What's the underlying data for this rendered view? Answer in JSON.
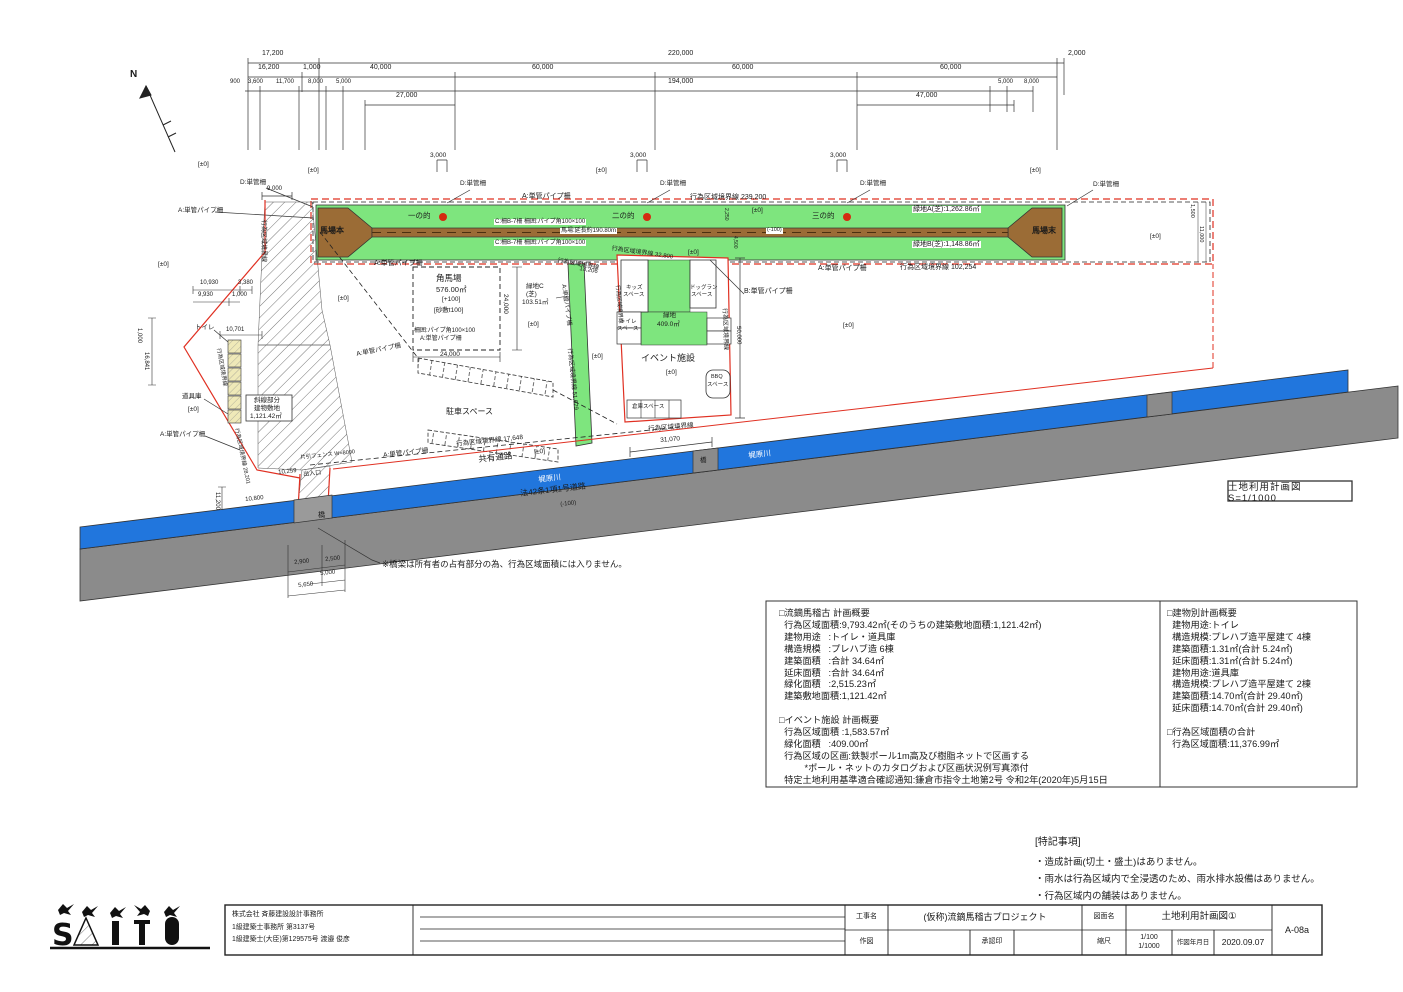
{
  "stamp": "土地利用計画図  S=1/1000",
  "notes": {
    "title": "[特記事項]",
    "items": [
      "・造成計画(切土・盛土)はありません。",
      "・雨水は行為区域内で全浸透のため、雨水排水設備はありません。",
      "・行為区域内の舗装はありません。"
    ]
  },
  "summary": {
    "left": [
      "□流鏑馬稽古 計画概要",
      "  行為区域面積:9,793.42㎡(そのうちの建築敷地面積:1,121.42㎡)",
      "  建物用途   :トイレ・道具庫",
      "  構造規模   :プレハブ造 6棟",
      "  建築面積   :合計 34.64㎡",
      "  延床面積   :合計 34.64㎡",
      "  緑化面積   :2,515.23㎡",
      "  建築敷地面積:1,121.42㎡",
      "",
      "□イベント施設 計画概要",
      "  行為区域面積 :1,583.57㎡",
      "  緑化面積   :409.00㎡",
      "  行為区域の区画:鉄製ポール1m高及び樹脂ネットで区画する",
      "          *ポール・ネットのカタログおよび区画状況例写真添付",
      "  特定土地利用基準適合確認通知:鎌倉市指令土地第2号 令和2年(2020年)5月15日"
    ],
    "right": [
      "□建物別計画概要",
      "  建物用途:トイレ",
      "  構造規模:プレハブ造平屋建て 4棟",
      "  建築面積:1.31㎡(合計 5.24㎡)",
      "  延床面積:1.31㎡(合計 5.24㎡)",
      "  建物用途:道具庫",
      "  構造規模:プレハブ造平屋建て 2棟",
      "  建築面積:14.70㎡(合計 29.40㎡)",
      "  延床面積:14.70㎡(合計 29.40㎡)",
      "",
      "□行為区域面積の合計",
      "  行為区域面積:11,376.99㎡"
    ]
  },
  "titleblock": {
    "company_lines": [
      "株式会社 斉藤建設設計事務所",
      "1級建築士事務所 第3137号",
      "1級建築士(大臣)第129575号 渡邉 俊彦"
    ],
    "labels": {
      "project": "工事名",
      "drawn": "作図",
      "approval": "承認印",
      "drawing_name": "図面名",
      "scale": "縮尺",
      "date": "作図年月日"
    },
    "values": {
      "project": "(仮称)流鏑馬稽古プロジェクト",
      "drawing_name": "土地利用計画図①",
      "scale1": "1/100",
      "scale2": "1/1000",
      "date": "2020.09.07",
      "sheet": "A-08a"
    }
  },
  "colors": {
    "turf_green": "#7ee57e",
    "track_brown": "#9b6c36",
    "river_blue": "#2176dd",
    "road_gray": "#8b8b8b",
    "boundary_red": "#e03022",
    "target_red": "#d42a10"
  },
  "labels": [
    {
      "n": "dim-label",
      "t": "17,200",
      "x": 262,
      "y": 50
    },
    {
      "n": "dim-label",
      "t": "220,000",
      "x": 668,
      "y": 50
    },
    {
      "n": "dim-label",
      "t": "2,000",
      "x": 1068,
      "y": 50
    },
    {
      "n": "dim-label",
      "t": "16,200",
      "x": 258,
      "y": 64
    },
    {
      "n": "dim-label",
      "t": "1,000",
      "x": 303,
      "y": 64
    },
    {
      "n": "dim-label",
      "t": "40,000",
      "x": 370,
      "y": 64
    },
    {
      "n": "dim-label",
      "t": "60,000",
      "x": 532,
      "y": 64
    },
    {
      "n": "dim-label",
      "t": "60,000",
      "x": 732,
      "y": 64
    },
    {
      "n": "dim-label",
      "t": "60,000",
      "x": 940,
      "y": 64
    },
    {
      "n": "dim-label",
      "t": "900",
      "x": 230,
      "y": 79,
      "s": 6
    },
    {
      "n": "dim-label",
      "t": "3,600",
      "x": 248,
      "y": 79,
      "s": 6
    },
    {
      "n": "dim-label",
      "t": "11,700",
      "x": 276,
      "y": 79,
      "s": 6
    },
    {
      "n": "dim-label",
      "t": "8,000",
      "x": 308,
      "y": 79,
      "s": 6
    },
    {
      "n": "dim-label",
      "t": "5,000",
      "x": 336,
      "y": 79,
      "s": 6
    },
    {
      "n": "dim-label",
      "t": "194,000",
      "x": 668,
      "y": 78
    },
    {
      "n": "dim-label",
      "t": "5,000",
      "x": 998,
      "y": 79,
      "s": 6
    },
    {
      "n": "dim-label",
      "t": "8,000",
      "x": 1024,
      "y": 79,
      "s": 6
    },
    {
      "n": "dim-label",
      "t": "27,000",
      "x": 396,
      "y": 92
    },
    {
      "n": "dim-label",
      "t": "47,000",
      "x": 916,
      "y": 92
    },
    {
      "n": "north-label",
      "t": "N",
      "x": 130,
      "y": 70,
      "s": 10,
      "b": 1
    },
    {
      "n": "fence-label",
      "t": "D:単管柵",
      "x": 240,
      "y": 180,
      "s": 6.5
    },
    {
      "n": "dim-label",
      "t": "9,000",
      "x": 267,
      "y": 186,
      "s": 6
    },
    {
      "n": "level-label",
      "t": "[±0]",
      "x": 198,
      "y": 162,
      "s": 6.5
    },
    {
      "n": "fence-label",
      "t": "A:単管パイプ柵",
      "x": 178,
      "y": 208,
      "s": 6.5
    },
    {
      "n": "boundary-label",
      "t": "行為区域境界線",
      "x": 266,
      "y": 220,
      "s": 6,
      "r": 90
    },
    {
      "n": "level-label",
      "t": "[±0]",
      "x": 158,
      "y": 262,
      "s": 6.5
    },
    {
      "n": "area-label",
      "t": "馬場本",
      "x": 320,
      "y": 227,
      "s": 8,
      "b": 1
    },
    {
      "n": "area-label",
      "t": "馬場末",
      "x": 1032,
      "y": 227,
      "s": 8,
      "b": 1
    },
    {
      "n": "target-label",
      "t": "一の的",
      "x": 408,
      "y": 212,
      "s": 7.5
    },
    {
      "n": "target-label",
      "t": "二の的",
      "x": 612,
      "y": 212,
      "s": 7.5
    },
    {
      "n": "target-label",
      "t": "三の的",
      "x": 812,
      "y": 212,
      "s": 7.5
    },
    {
      "n": "level-label",
      "t": "[±0]",
      "x": 308,
      "y": 168,
      "s": 6.5
    },
    {
      "n": "dim-label",
      "t": "3,000",
      "x": 430,
      "y": 153,
      "s": 6.5
    },
    {
      "n": "fence-label",
      "t": "D:単管柵",
      "x": 460,
      "y": 181,
      "s": 6.5
    },
    {
      "n": "level-label",
      "t": "[±0]",
      "x": 596,
      "y": 168,
      "s": 6.5
    },
    {
      "n": "dim-label",
      "t": "3,000",
      "x": 630,
      "y": 153,
      "s": 6.5
    },
    {
      "n": "fence-label",
      "t": "D:単管柵",
      "x": 660,
      "y": 181,
      "s": 6.5
    },
    {
      "n": "dim-label",
      "t": "3,000",
      "x": 830,
      "y": 153,
      "s": 6.5
    },
    {
      "n": "fence-label",
      "t": "D:単管柵",
      "x": 860,
      "y": 181,
      "s": 6.5
    },
    {
      "n": "level-label",
      "t": "[±0]",
      "x": 1030,
      "y": 168,
      "s": 6.5
    },
    {
      "n": "fence-label",
      "t": "D:単管柵",
      "x": 1093,
      "y": 182,
      "s": 6.5
    },
    {
      "n": "fence-label",
      "t": "A:単管パイプ柵",
      "x": 522,
      "y": 193,
      "s": 7
    },
    {
      "n": "boundary-label",
      "t": "行為区域境界線 239,200",
      "x": 690,
      "y": 194,
      "s": 7
    },
    {
      "n": "area-label",
      "t": "緑地A(芝):1,262.86㎡",
      "x": 912,
      "y": 206,
      "s": 7,
      "f": 1
    },
    {
      "n": "area-label",
      "t": "緑地B(芝):1,148.86㎡",
      "x": 912,
      "y": 241,
      "s": 7,
      "f": 1
    },
    {
      "n": "fence-label",
      "t": "C:柵B-7柵 柵囲:パイプ角100×100",
      "x": 494,
      "y": 219,
      "s": 6,
      "f": 1
    },
    {
      "n": "track-label",
      "t": "馬場:延長約190.80m",
      "x": 560,
      "y": 228,
      "s": 6,
      "f": 1
    },
    {
      "n": "fence-label",
      "t": "C:柵B-7柵 柵囲:パイプ角100×100",
      "x": 494,
      "y": 240,
      "s": 6,
      "f": 1
    },
    {
      "n": "level-label",
      "t": "[±0]",
      "x": 752,
      "y": 208,
      "s": 6.5
    },
    {
      "n": "level-label",
      "t": "(-100)",
      "x": 766,
      "y": 228,
      "s": 5.5,
      "f": 1
    },
    {
      "n": "level-label",
      "t": "[±0]",
      "x": 688,
      "y": 250,
      "s": 6.5
    },
    {
      "n": "fence-label",
      "t": "A:単管パイプ柵",
      "x": 818,
      "y": 265,
      "s": 7
    },
    {
      "n": "boundary-label",
      "t": "行為区域境界線 102,254",
      "x": 900,
      "y": 264,
      "s": 7
    },
    {
      "n": "fence-label",
      "t": "A:単管パイプ柵",
      "x": 374,
      "y": 260,
      "s": 7
    },
    {
      "n": "boundary-label",
      "t": "行為区域境界線 32,800",
      "x": 612,
      "y": 246,
      "s": 6,
      "r": 8
    },
    {
      "n": "dim-label",
      "t": "1,500",
      "x": 1194,
      "y": 204,
      "s": 5.5,
      "r": 90
    },
    {
      "n": "dim-label",
      "t": "11,000",
      "x": 1203,
      "y": 226,
      "s": 5.5,
      "r": 90
    },
    {
      "n": "level-label",
      "t": "[±0]",
      "x": 1150,
      "y": 234,
      "s": 6.5
    },
    {
      "n": "dim-label",
      "t": "2,250",
      "x": 728,
      "y": 208,
      "s": 5,
      "r": 90
    },
    {
      "n": "dim-label",
      "t": "4,500",
      "x": 737,
      "y": 236,
      "s": 5,
      "r": 90
    },
    {
      "n": "area-label",
      "t": "角馬場",
      "x": 436,
      "y": 274,
      "s": 8.5
    },
    {
      "n": "area-label",
      "t": "576.00㎡",
      "x": 436,
      "y": 286,
      "s": 7.5
    },
    {
      "n": "level-label",
      "t": "[+100]",
      "x": 442,
      "y": 297,
      "s": 6.5
    },
    {
      "n": "level-label",
      "t": "[砂敷t100]",
      "x": 434,
      "y": 308,
      "s": 6.5
    },
    {
      "n": "fence-label",
      "t": "柵囲:パイプ角100×100",
      "x": 414,
      "y": 328,
      "s": 6
    },
    {
      "n": "fence-label",
      "t": "A:単管パイプ柵",
      "x": 420,
      "y": 336,
      "s": 6
    },
    {
      "n": "dim-label",
      "t": "24,000",
      "x": 508,
      "y": 294,
      "s": 6.5,
      "r": 90
    },
    {
      "n": "dim-label",
      "t": "24,000",
      "x": 440,
      "y": 352,
      "s": 6.5
    },
    {
      "n": "level-label",
      "t": "[±0]",
      "x": 338,
      "y": 296,
      "s": 6.5
    },
    {
      "n": "area-label",
      "t": "緑地C",
      "x": 526,
      "y": 284,
      "s": 6.5
    },
    {
      "n": "area-label",
      "t": "(芝)",
      "x": 526,
      "y": 292,
      "s": 6.5
    },
    {
      "n": "area-label",
      "t": "103.51㎡",
      "x": 522,
      "y": 300,
      "s": 6.5
    },
    {
      "n": "boundary-label",
      "t": "行為区域境界線",
      "x": 558,
      "y": 258,
      "s": 6,
      "r": 10
    },
    {
      "n": "dim-label",
      "t": "13,206",
      "x": 580,
      "y": 266,
      "s": 6,
      "r": 10
    },
    {
      "n": "fence-label",
      "t": "A:単管パイプ柵",
      "x": 566,
      "y": 284,
      "s": 6,
      "r": 82
    },
    {
      "n": "boundary-label",
      "t": "行為区域境界線 51,629",
      "x": 572,
      "y": 348,
      "s": 6,
      "r": 84
    },
    {
      "n": "level-label",
      "t": "[±0]",
      "x": 528,
      "y": 322,
      "s": 6.5
    },
    {
      "n": "level-label",
      "t": "[±0]",
      "x": 592,
      "y": 354,
      "s": 6.5
    },
    {
      "n": "area-label",
      "t": "キッズ",
      "x": 626,
      "y": 286,
      "s": 5.5
    },
    {
      "n": "area-label",
      "t": "スペース",
      "x": 623,
      "y": 293,
      "s": 5.5
    },
    {
      "n": "area-label",
      "t": "ドッグラン",
      "x": 690,
      "y": 286,
      "s": 5.5
    },
    {
      "n": "area-label",
      "t": "スペース",
      "x": 691,
      "y": 293,
      "s": 5.5
    },
    {
      "n": "area-label",
      "t": "緑地",
      "x": 663,
      "y": 313,
      "s": 6.5
    },
    {
      "n": "area-label",
      "t": "409.0㎡",
      "x": 657,
      "y": 322,
      "s": 6.5
    },
    {
      "n": "area-label",
      "t": "トイレ",
      "x": 620,
      "y": 320,
      "s": 5.5
    },
    {
      "n": "area-label",
      "t": "スペース",
      "x": 617,
      "y": 327,
      "s": 5.5
    },
    {
      "n": "area-label",
      "t": "イベント施設",
      "x": 641,
      "y": 354,
      "s": 9
    },
    {
      "n": "level-label",
      "t": "[±0]",
      "x": 666,
      "y": 370,
      "s": 6.5
    },
    {
      "n": "area-label",
      "t": "BBQ",
      "x": 711,
      "y": 375,
      "s": 5.5
    },
    {
      "n": "area-label",
      "t": "スペース",
      "x": 707,
      "y": 383,
      "s": 5.5
    },
    {
      "n": "area-label",
      "t": "倉庫スペース",
      "x": 632,
      "y": 405,
      "s": 5.5
    },
    {
      "n": "boundary-label",
      "t": "行為区域境界線",
      "x": 648,
      "y": 427,
      "s": 6.5,
      "r": -5
    },
    {
      "n": "dim-label",
      "t": "31,070",
      "x": 660,
      "y": 438,
      "s": 6.5,
      "r": -5
    },
    {
      "n": "fence-label",
      "t": "B:単管パイプ柵",
      "x": 744,
      "y": 288,
      "s": 7
    },
    {
      "n": "boundary-label",
      "t": "行為区域境界線",
      "x": 727,
      "y": 308,
      "s": 6,
      "r": 88
    },
    {
      "n": "dim-label",
      "t": "50,000",
      "x": 741,
      "y": 326,
      "s": 6,
      "r": 88
    },
    {
      "n": "boundary-label",
      "t": "行為区域境界線",
      "x": 619,
      "y": 285,
      "s": 5.5,
      "r": 85
    },
    {
      "n": "level-label",
      "t": "[±0]",
      "x": 843,
      "y": 323,
      "s": 6.5
    },
    {
      "n": "area-label",
      "t": "トイレ",
      "x": 195,
      "y": 325,
      "s": 6.5
    },
    {
      "n": "dim-label",
      "t": "10,701",
      "x": 226,
      "y": 327,
      "s": 6
    },
    {
      "n": "dim-label",
      "t": "10,930",
      "x": 200,
      "y": 280,
      "s": 6
    },
    {
      "n": "dim-label",
      "t": "3,380",
      "x": 238,
      "y": 280,
      "s": 6
    },
    {
      "n": "dim-label",
      "t": "9,930",
      "x": 198,
      "y": 292,
      "s": 6
    },
    {
      "n": "dim-label",
      "t": "1,000",
      "x": 232,
      "y": 292,
      "s": 6
    },
    {
      "n": "dim-label",
      "t": "1,000",
      "x": 142,
      "y": 328,
      "s": 6,
      "r": 90
    },
    {
      "n": "dim-label",
      "t": "16,841",
      "x": 149,
      "y": 352,
      "s": 6,
      "r": 90
    },
    {
      "n": "area-label",
      "t": "道具庫",
      "x": 182,
      "y": 394,
      "s": 6.5
    },
    {
      "n": "level-label",
      "t": "[±0]",
      "x": 188,
      "y": 407,
      "s": 6.5
    },
    {
      "n": "fence-label",
      "t": "A:単管パイプ柵",
      "x": 160,
      "y": 432,
      "s": 6.5
    },
    {
      "n": "area-label",
      "t": "斜線部分",
      "x": 254,
      "y": 398,
      "s": 6.5
    },
    {
      "n": "area-label",
      "t": "建物敷地",
      "x": 254,
      "y": 406,
      "s": 6.5
    },
    {
      "n": "area-label",
      "t": "1,121.42㎡",
      "x": 250,
      "y": 414,
      "s": 6.5
    },
    {
      "n": "boundary-label",
      "t": "行為区域境界線 28,201",
      "x": 238,
      "y": 428,
      "s": 5.5,
      "r": 78
    },
    {
      "n": "boundary-label",
      "t": "行為区域境界線",
      "x": 220,
      "y": 348,
      "s": 5.5,
      "r": 80
    },
    {
      "n": "dim-label",
      "t": "10,259",
      "x": 278,
      "y": 470,
      "s": 6,
      "r": -6
    },
    {
      "n": "area-label",
      "t": "出入口",
      "x": 303,
      "y": 472,
      "s": 6,
      "r": -6
    },
    {
      "n": "fence-label",
      "t": "片引フェンス W=8000",
      "x": 300,
      "y": 456,
      "s": 5.5,
      "r": -6
    },
    {
      "n": "fence-label",
      "t": "A:単管パイプ柵",
      "x": 383,
      "y": 453,
      "s": 6.5,
      "r": -6
    },
    {
      "n": "boundary-label",
      "t": "行為区域境界線 17,648",
      "x": 456,
      "y": 442,
      "s": 6.5,
      "r": -6
    },
    {
      "n": "area-label",
      "t": "共有通路",
      "x": 478,
      "y": 455,
      "s": 8.5,
      "r": -6
    },
    {
      "n": "level-label",
      "t": "[±0]",
      "x": 534,
      "y": 450,
      "s": 6.5,
      "r": -6
    },
    {
      "n": "area-label",
      "t": "駐車スペース",
      "x": 446,
      "y": 408,
      "s": 8
    },
    {
      "n": "fence-label",
      "t": "A:単管パイプ柵",
      "x": 356,
      "y": 352,
      "s": 6.5,
      "r": -11
    },
    {
      "n": "dim-label",
      "t": "11,200",
      "x": 220,
      "y": 492,
      "s": 6,
      "r": 90
    },
    {
      "n": "dim-label",
      "t": "10,800",
      "x": 245,
      "y": 497,
      "s": 6,
      "r": -6
    },
    {
      "n": "area-label",
      "t": "橋",
      "x": 318,
      "y": 512,
      "s": 7
    },
    {
      "n": "area-label",
      "t": "梶原川",
      "x": 538,
      "y": 476,
      "s": 7.5,
      "r": -6.5,
      "c": "#ffffff"
    },
    {
      "n": "area-label",
      "t": "法42条1項1号道路",
      "x": 520,
      "y": 490,
      "s": 8,
      "r": -6.5
    },
    {
      "n": "level-label",
      "t": "(-100)",
      "x": 560,
      "y": 502,
      "s": 6,
      "r": -6.5
    },
    {
      "n": "area-label",
      "t": "梶原川",
      "x": 748,
      "y": 452,
      "s": 7.5,
      "r": -6.5,
      "c": "#ffffff"
    },
    {
      "n": "area-label",
      "t": "橋",
      "x": 700,
      "y": 458,
      "s": 6.5
    },
    {
      "n": "dim-label",
      "t": "2,900",
      "x": 294,
      "y": 560,
      "s": 6,
      "r": -6
    },
    {
      "n": "dim-label",
      "t": "2,500",
      "x": 325,
      "y": 557,
      "s": 6,
      "r": -6
    },
    {
      "n": "dim-label",
      "t": "5,000",
      "x": 320,
      "y": 571,
      "s": 6,
      "r": -6
    },
    {
      "n": "dim-label",
      "t": "5,650",
      "x": 298,
      "y": 583,
      "s": 6,
      "r": -6
    },
    {
      "n": "bridge-note",
      "t": "※橋梁は所有者の占有部分の為、行為区域面積には入りません。",
      "x": 382,
      "y": 560,
      "s": 8.5
    }
  ]
}
